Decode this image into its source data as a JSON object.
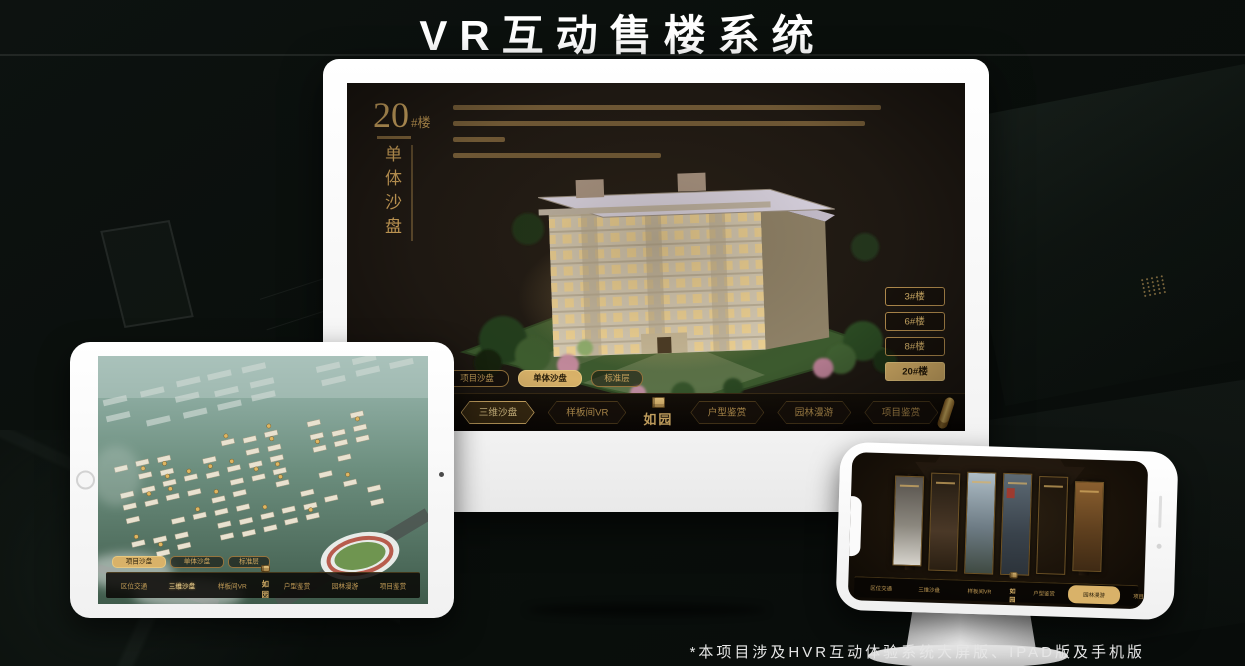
{
  "title": "VR互动售楼系统",
  "footnote": "*本项目涉及HVR互动体验系统大屏版、IPAD版及手机版",
  "brand": {
    "logo": "如园"
  },
  "colors": {
    "gold": "#d9b269",
    "gold_text": "#c9a25e",
    "screen_bg": "#1e1812",
    "background": "#0b0f0c",
    "device_white": "#fafafa"
  },
  "icons": {
    "nav_end": "gold-scroll-icon",
    "logo_seal": "gold-seal-icon"
  },
  "nav": {
    "items": [
      {
        "label": "区位交通"
      },
      {
        "label": "三维沙盘"
      },
      {
        "label": "样板间VR"
      },
      {
        "label": "户型鉴赏"
      },
      {
        "label": "园林漫游"
      },
      {
        "label": "项目鉴赏"
      }
    ]
  },
  "view_tabs": {
    "labels": [
      "项目沙盘",
      "单体沙盘",
      "标准层"
    ]
  },
  "monitor": {
    "hero": {
      "number": "20",
      "suffix": "#楼",
      "subtitle": "单体沙盘"
    },
    "floor_buttons": [
      {
        "label": "3#楼",
        "active": false
      },
      {
        "label": "6#楼",
        "active": false
      },
      {
        "label": "8#楼",
        "active": false
      },
      {
        "label": "20#楼",
        "active": true
      }
    ],
    "active_view_tab": "单体沙盘",
    "active_nav": "三维沙盘"
  },
  "tablet": {
    "active_view_tab": "项目沙盘",
    "active_nav": "三维沙盘"
  },
  "phone": {
    "active_nav": "园林漫游"
  }
}
